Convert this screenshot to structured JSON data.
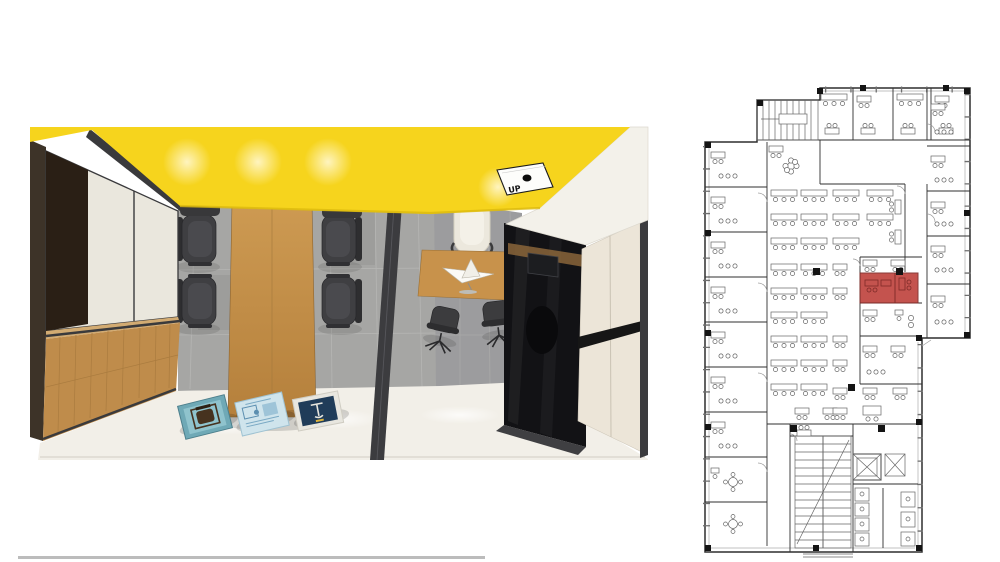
{
  "page": {
    "background": "#ffffff",
    "bottom_divider_color": "#bcbcbc"
  },
  "render_3d": {
    "title": "office-interior-top-down-render",
    "ceiling_label": "UP",
    "colors": {
      "ceiling_yellow": "#f6d41d",
      "wood": "#c2914c",
      "credenza_wood": "#bf8c4b",
      "floor_meeting_gray": "#a6a6a4",
      "floor_office_gray": "#9c9c9e",
      "floor_near_white": "#f2efe8",
      "frame_dark": "#3a3a3c",
      "glass_black": "#121215",
      "panel_cream": "#ece5d8",
      "soffit_white": "#f3f1ea",
      "chair_dark": "#3f3f42",
      "chair_white": "#ece8dd",
      "poster_teal": "#6fa9b6",
      "poster_light_blue": "#cfe4ec",
      "poster_navy": "#203c59"
    },
    "furniture": {
      "meeting_table_seats": 6,
      "office_guest_chairs": 2,
      "executive_chair": 1,
      "floor_posters": 3
    }
  },
  "floor_plan": {
    "title": "office-floor-plan",
    "ink_color": "#666666",
    "wall_color": "#2f2f2f",
    "column_color": "#141414",
    "window_color": "#ababab",
    "highlight_room": {
      "fill": "#bf4540",
      "stroke": "#7e2b28"
    }
  }
}
